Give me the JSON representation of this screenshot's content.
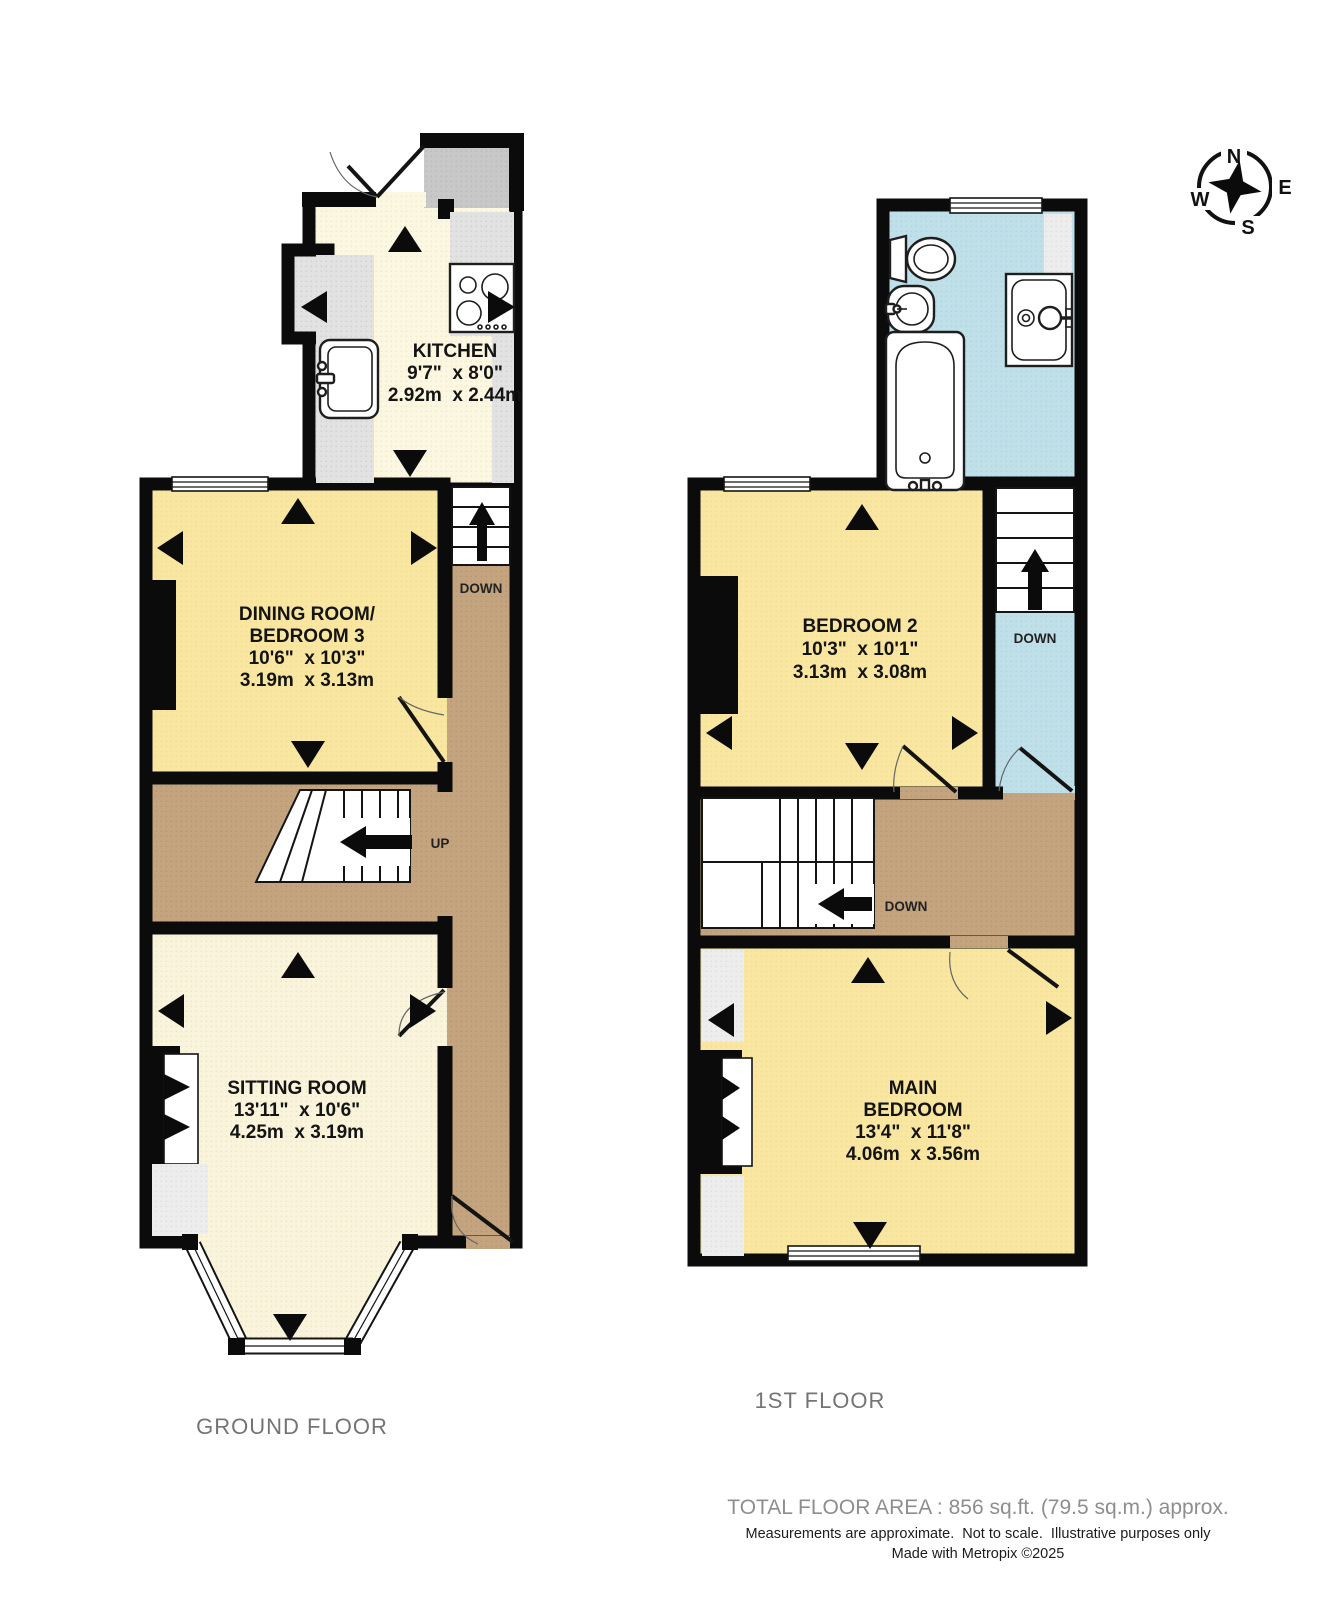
{
  "compass": {
    "north": "N",
    "east": "E",
    "south": "S",
    "west": "W"
  },
  "ground_floor": {
    "label": "GROUND FLOOR",
    "kitchen": {
      "name": "KITCHEN",
      "imperial": "9'7\"  x 8'0\"",
      "metric": "2.92m  x 2.44m"
    },
    "dining_room": {
      "name_line1": "DINING ROOM/",
      "name_line2": "BEDROOM 3",
      "imperial": "10'6\"  x 10'3\"",
      "metric": "3.19m  x 3.13m"
    },
    "sitting_room": {
      "name": "SITTING ROOM",
      "imperial": "13'11\"  x 10'6\"",
      "metric": "4.25m  x 3.19m"
    },
    "cellar_stairs_label": "DOWN",
    "stairs_up_label": "UP"
  },
  "first_floor": {
    "label": "1ST FLOOR",
    "bedroom2": {
      "name": "BEDROOM 2",
      "imperial": "10'3\"  x 10'1\"",
      "metric": "3.13m  x 3.08m"
    },
    "main_bedroom": {
      "name_line1": "MAIN",
      "name_line2": "BEDROOM",
      "imperial": "13'4\"  x 11'8\"",
      "metric": "4.06m  x 3.56m"
    },
    "stairs_down_label": "DOWN",
    "landing_down_label": "DOWN"
  },
  "footer": {
    "total_area": "TOTAL FLOOR AREA : 856 sq.ft. (79.5 sq.m.) approx.",
    "disclaimer": "Measurements are approximate.  Not to scale.  Illustrative purposes only",
    "credit": "Made with Metropix ©2025"
  },
  "colors": {
    "wall": "#0b0b0b",
    "room_yellow": "#f9e7a1",
    "room_cream": "#f9f4db",
    "kitchen_cream": "#fbf7e0",
    "hallway_tan": "#c3a47e",
    "bathroom_blue": "#bfe0e8",
    "counter_grey": "#e2e2e2",
    "porch_grey": "#c8c8c8",
    "patch_grey": "#ededed"
  }
}
